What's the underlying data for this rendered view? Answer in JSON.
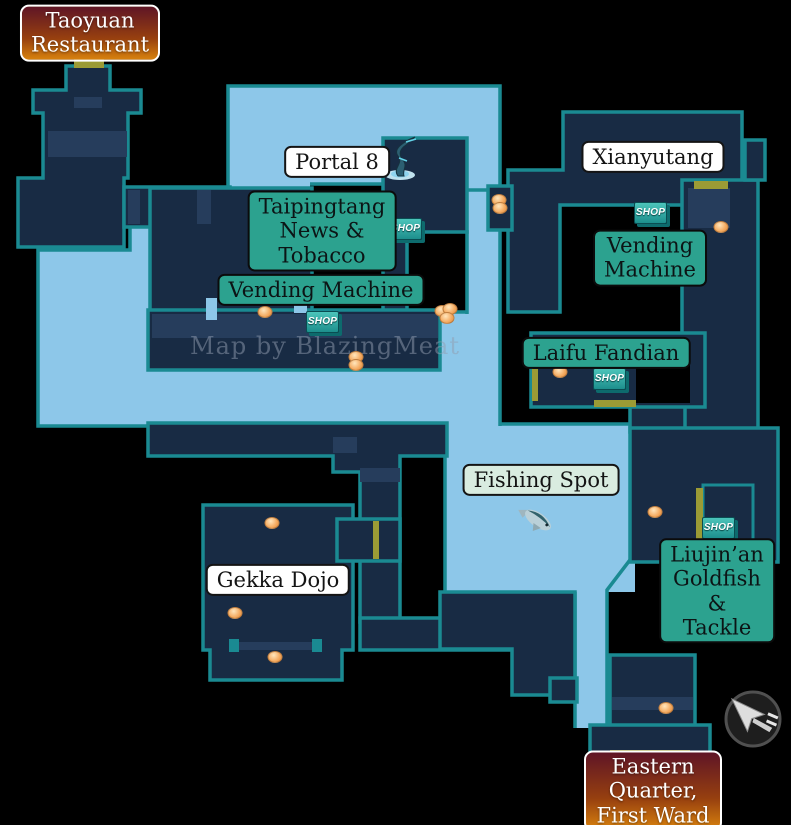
{
  "map": {
    "watermark": "Map by BlazingMeat",
    "shop_badge_text": "SHOP",
    "colors": {
      "street": "#8dc7e9",
      "building": "#182b44",
      "building-light": "#263d5c",
      "outline": "#1a8a92",
      "door": "#9b9b35",
      "label-teal": "#2ca28f",
      "label-white": "#ffffff",
      "label-mint": "#d9ece0",
      "item": "#f4a95e"
    },
    "labels": [
      {
        "id": "label-taoyuan-restaurant",
        "text": "Taoyuan\nRestaurant",
        "style": "exit",
        "x": 90,
        "y": 33
      },
      {
        "id": "label-portal-8",
        "text": "Portal 8",
        "style": "white",
        "x": 337,
        "y": 162
      },
      {
        "id": "label-taipingtang-news-tobacco",
        "text": "Taipingtang\nNews &\nTobacco",
        "style": "shop",
        "x": 322,
        "y": 231
      },
      {
        "id": "label-vending-machine-west",
        "text": "Vending Machine",
        "style": "shop",
        "x": 321,
        "y": 290
      },
      {
        "id": "label-xianyutang",
        "text": "Xianyutang",
        "style": "white",
        "x": 653,
        "y": 157
      },
      {
        "id": "label-vending-machine-east",
        "text": "Vending\nMachine",
        "style": "shop",
        "x": 650,
        "y": 258
      },
      {
        "id": "label-laifu-fandian",
        "text": "Laifu Fandian",
        "style": "shop",
        "x": 606,
        "y": 353
      },
      {
        "id": "label-fishing-spot",
        "text": "Fishing Spot",
        "style": "mint",
        "x": 541,
        "y": 480
      },
      {
        "id": "label-gekka-dojo",
        "text": "Gekka Dojo",
        "style": "white",
        "x": 278,
        "y": 580
      },
      {
        "id": "label-liujinan-goldfish-tackle",
        "text": "Liujin’an\nGoldfish\n& Tackle",
        "style": "shop",
        "x": 717,
        "y": 591
      },
      {
        "id": "label-eastern-quarter-first-ward",
        "text": "Eastern Quarter,\nFirst Ward",
        "style": "exit",
        "x": 653,
        "y": 791
      }
    ],
    "shop_badges": [
      {
        "x": 389,
        "y": 218
      },
      {
        "x": 306,
        "y": 311
      },
      {
        "x": 634,
        "y": 202
      },
      {
        "x": 593,
        "y": 368
      },
      {
        "x": 702,
        "y": 517
      }
    ],
    "items": [
      {
        "x": 265,
        "y": 312
      },
      {
        "x": 356,
        "y": 357
      },
      {
        "x": 356,
        "y": 365
      },
      {
        "x": 442,
        "y": 311
      },
      {
        "x": 450,
        "y": 309
      },
      {
        "x": 447,
        "y": 318
      },
      {
        "x": 499,
        "y": 200
      },
      {
        "x": 500,
        "y": 208
      },
      {
        "x": 721,
        "y": 227
      },
      {
        "x": 560,
        "y": 372
      },
      {
        "x": 272,
        "y": 523
      },
      {
        "x": 235,
        "y": 613
      },
      {
        "x": 275,
        "y": 657
      },
      {
        "x": 655,
        "y": 512
      },
      {
        "x": 666,
        "y": 708
      }
    ]
  }
}
